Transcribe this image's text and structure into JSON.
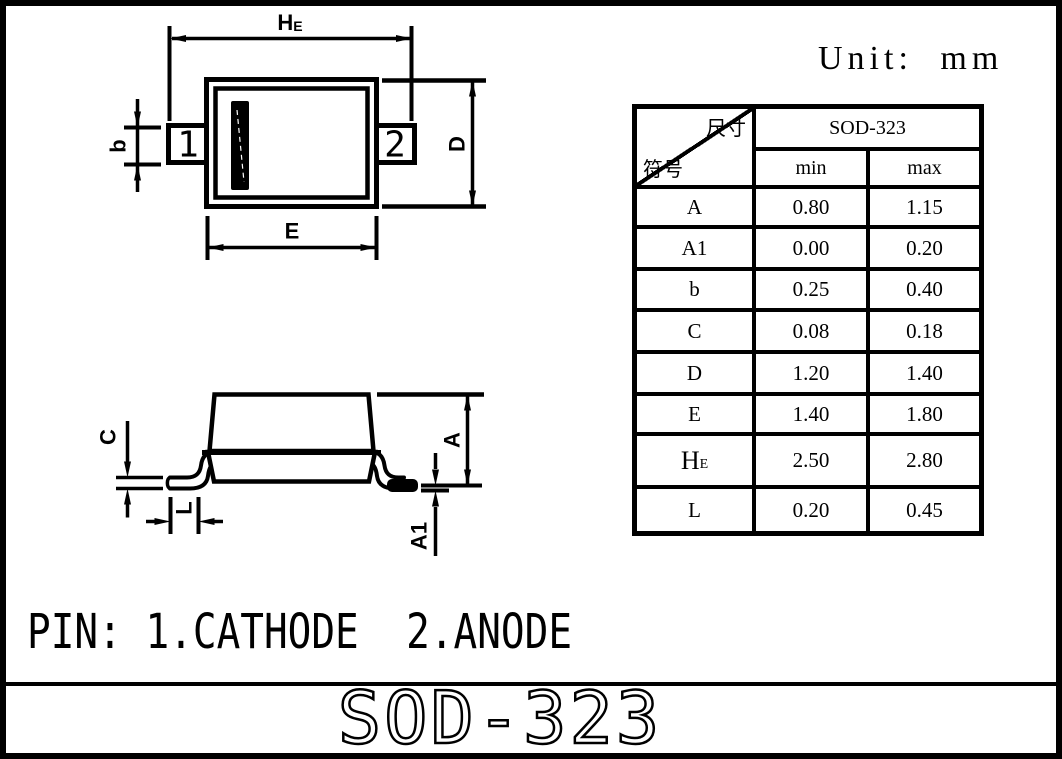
{
  "unit_label": "Unit: mm",
  "pin_note": "PIN: 1.CATHODE  2.ANODE",
  "footer_title": "SOD-323",
  "pins": {
    "p1": "1",
    "p2": "2"
  },
  "dims": {
    "he_main": "H",
    "he_sub": "E",
    "b": "b",
    "d": "D",
    "e": "E",
    "c": "C",
    "l": "L",
    "a": "A",
    "a1": "A1"
  },
  "table": {
    "header": {
      "corner_top": "尺寸",
      "corner_bottom": "符号",
      "package": "SOD-323",
      "min": "min",
      "max": "max"
    },
    "rows": [
      {
        "symbol": "A",
        "min": "0.80",
        "max": "1.15"
      },
      {
        "symbol": "A1",
        "min": "0.00",
        "max": "0.20"
      },
      {
        "symbol": "b",
        "min": "0.25",
        "max": "0.40"
      },
      {
        "symbol": "C",
        "min": "0.08",
        "max": "0.18"
      },
      {
        "symbol": "D",
        "min": "1.20",
        "max": "1.40"
      },
      {
        "symbol": "E",
        "min": "1.40",
        "max": "1.80"
      },
      {
        "symbol": "HE",
        "symbol_main": "H",
        "symbol_sub": "E",
        "min": "2.50",
        "max": "2.80"
      },
      {
        "symbol": "L",
        "min": "0.20",
        "max": "0.45"
      }
    ]
  },
  "colors": {
    "ink": "#000000",
    "paper": "#ffffff"
  }
}
